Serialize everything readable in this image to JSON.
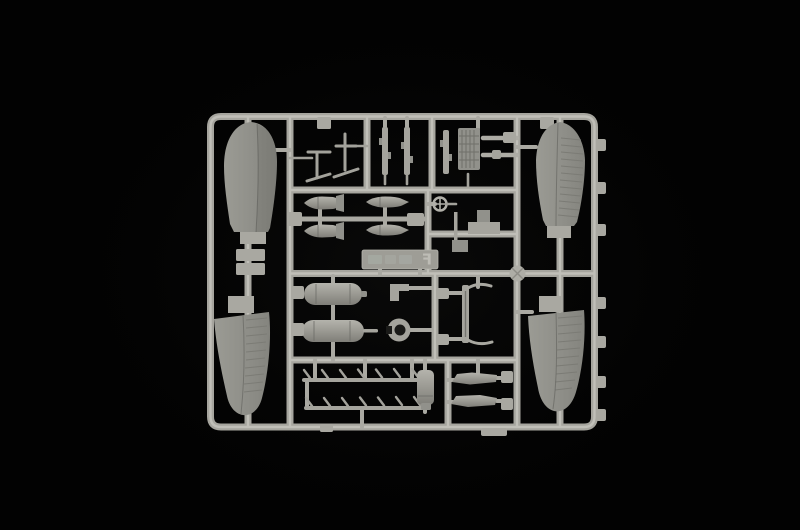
{
  "image": {
    "type": "photograph",
    "subject": "Light grey injection-molded plastic model kit sprue (parts frame) of aircraft parts on a black background",
    "background_color": "#020202",
    "plastic_runner_color": "#a6a59e",
    "plastic_part_color": "#91918b",
    "plastic_highlight_color": "#c4c3bc",
    "plastic_shadow_color": "#6c6c67"
  },
  "sprue": {
    "tag": {
      "letter": "F",
      "mirrored": true,
      "embossed_text_legible": false
    },
    "parts": [
      {
        "id": "wing-panel-top-left",
        "label": "wing panel",
        "count": 1
      },
      {
        "id": "wing-panel-bottom-left",
        "label": "wing panel with ribbed control surface",
        "count": 1
      },
      {
        "id": "wing-panel-top-right",
        "label": "wing panel with ribbed control surface",
        "count": 1
      },
      {
        "id": "wing-panel-bottom-right",
        "label": "wing panel with ribbed control surface",
        "count": 1
      },
      {
        "id": "antenna-masts",
        "label": "antenna / pitot masts",
        "count": 2
      },
      {
        "id": "struts",
        "label": "vertical strut parts",
        "count": 3
      },
      {
        "id": "radiator-block",
        "label": "gridded radiator block",
        "count": 1
      },
      {
        "id": "rods",
        "label": "push rods",
        "count": 2
      },
      {
        "id": "small-bombs-finned",
        "label": "small bombs with tail fins",
        "count": 2
      },
      {
        "id": "small-bombs",
        "label": "small streamlined bombs",
        "count": 2
      },
      {
        "id": "tail-wheel",
        "label": "small spoked wheel",
        "count": 1
      },
      {
        "id": "stepped-mount",
        "label": "stepped mount / seat part",
        "count": 1
      },
      {
        "id": "drop-tanks",
        "label": "drop tanks",
        "count": 2
      },
      {
        "id": "bracket",
        "label": "angled bracket",
        "count": 1
      },
      {
        "id": "cowl-ring",
        "label": "cowl ring",
        "count": 1
      },
      {
        "id": "ladder-frame",
        "label": "thin ladder frame",
        "count": 1
      },
      {
        "id": "exhaust-stacks",
        "label": "exhaust stack strips",
        "count": 2
      },
      {
        "id": "cylinder-tank",
        "label": "cylindrical tank",
        "count": 1
      },
      {
        "id": "blade-parts",
        "label": "blade / flap parts",
        "count": 2
      }
    ]
  }
}
